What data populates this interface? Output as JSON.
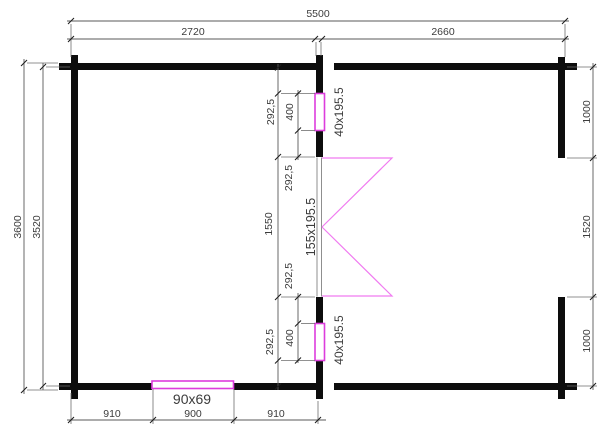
{
  "plan": {
    "colors": {
      "wall": "#0d0d0d",
      "dim_line": "#5a5a5a",
      "dim_text": "#3c3c3c",
      "accent": "#dd3ddd",
      "door_swing": "#f07af0"
    },
    "dims": {
      "overall_width": "5500",
      "width_left_room": "2720",
      "width_right_room": "2660",
      "overall_depth": "3600",
      "inner_depth": "3520",
      "right_wall_top": "1000",
      "right_opening": "1520",
      "right_wall_bottom": "1000",
      "bottom_left": "910",
      "bottom_window": "900",
      "bottom_right": "910",
      "column": [
        "292,5",
        "400",
        "292,5",
        "1550",
        "292,5",
        "400",
        "292,5"
      ]
    },
    "labels": {
      "window_top": "40x195.5",
      "door": "155x195.5",
      "window_bottom": "40x195.5",
      "window_south": "90x69"
    }
  }
}
